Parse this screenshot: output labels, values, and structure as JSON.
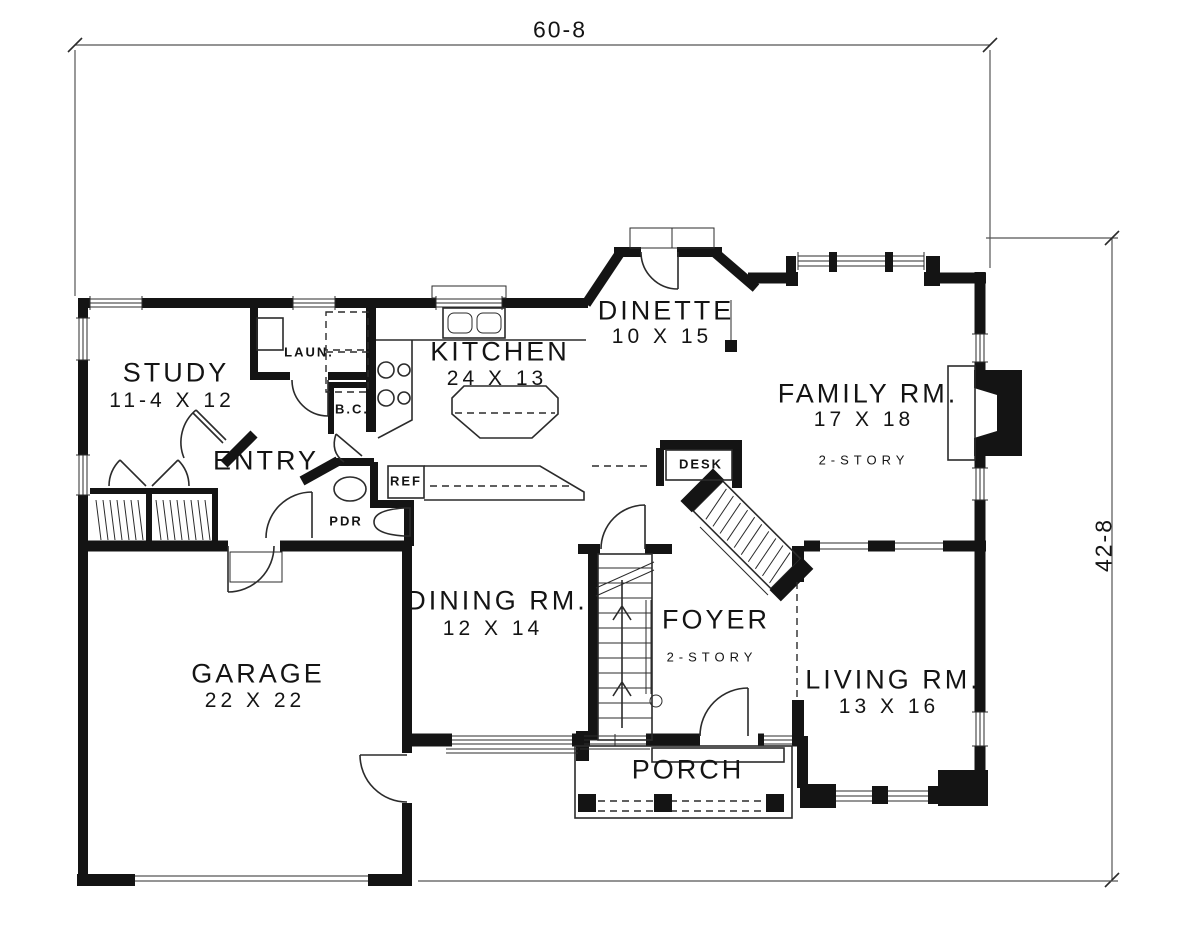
{
  "dimensions": {
    "overall_width": "60-8",
    "overall_height": "42-8"
  },
  "rooms": {
    "study": {
      "name": "STUDY",
      "size": "11-4 X 12"
    },
    "entry": {
      "name": "ENTRY"
    },
    "kitchen": {
      "name": "KITCHEN",
      "size": "24 X 13"
    },
    "dinette": {
      "name": "DINETTE",
      "size": "10 X 15"
    },
    "family": {
      "name": "FAMILY RM.",
      "size": "17 X 18",
      "note": "2-STORY"
    },
    "dining": {
      "name": "DINING RM.",
      "size": "12 X 14"
    },
    "foyer": {
      "name": "FOYER",
      "note": "2-STORY"
    },
    "living": {
      "name": "LIVING RM.",
      "size": "13 X 16"
    },
    "garage": {
      "name": "GARAGE",
      "size": "22 X 22"
    },
    "porch": {
      "name": "PORCH"
    }
  },
  "features": {
    "laundry": "LAUN.",
    "broom_closet": "B.C.",
    "desk": "DESK",
    "refrigerator": "REF",
    "powder_room": "PDR"
  },
  "colors": {
    "walls": "#141414",
    "lines": "#2b2b2b",
    "background": "#ffffff"
  }
}
